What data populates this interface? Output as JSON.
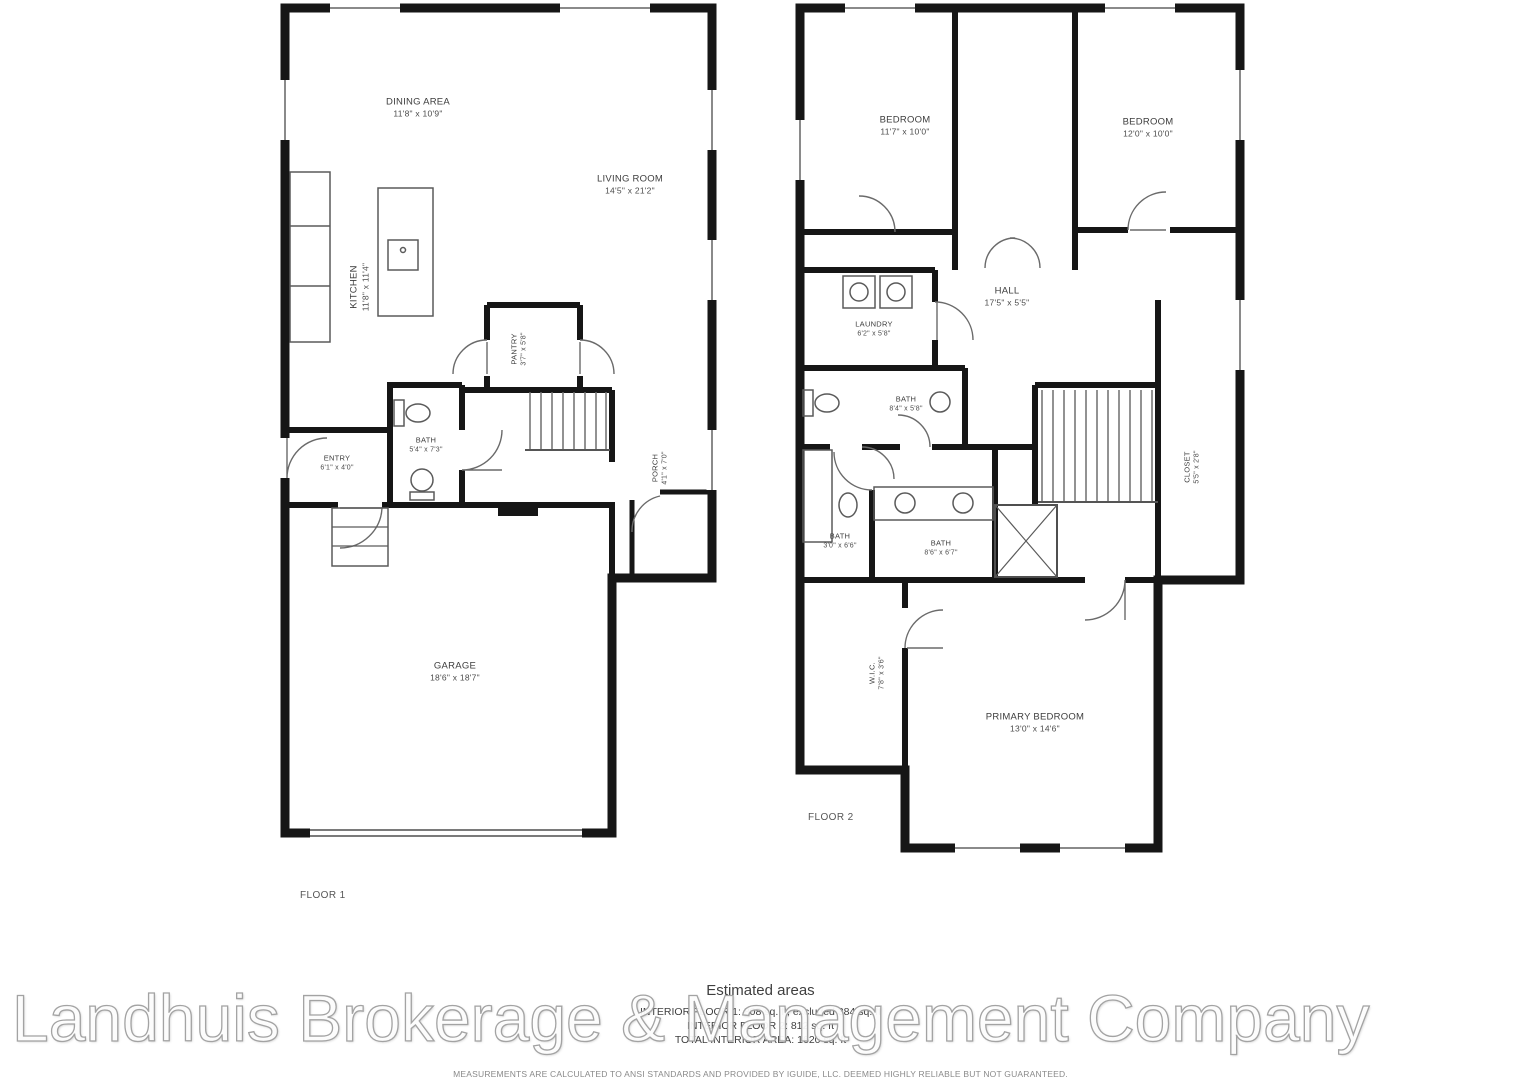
{
  "watermark": {
    "text": "Landhuis Brokerage & Management Company"
  },
  "floor1": {
    "name": "FLOOR 1",
    "rooms": {
      "dining": {
        "name": "DINING AREA",
        "dims": "11'8\" x 10'9\""
      },
      "living": {
        "name": "LIVING ROOM",
        "dims": "14'5\" x 21'2\""
      },
      "kitchen": {
        "name": "KITCHEN",
        "dims": "11'8\" x 11'4\""
      },
      "pantry": {
        "name": "PANTRY",
        "dims": "3'7\" x 5'8\""
      },
      "bath": {
        "name": "BATH",
        "dims": "5'4\" x 7'3\""
      },
      "entry": {
        "name": "ENTRY",
        "dims": "6'1\" x 4'0\""
      },
      "porch": {
        "name": "PORCH",
        "dims": "4'1\" x 7'0\""
      },
      "garage": {
        "name": "GARAGE",
        "dims": "18'6\" x 18'7\""
      }
    }
  },
  "floor2": {
    "name": "FLOOR 2",
    "rooms": {
      "bedroom_left": {
        "name": "BEDROOM",
        "dims": "11'7\" x 10'0\""
      },
      "bedroom_right": {
        "name": "BEDROOM",
        "dims": "12'0\" x 10'0\""
      },
      "laundry": {
        "name": "LAUNDRY",
        "dims": "6'2\" x 5'8\""
      },
      "hall": {
        "name": "HALL",
        "dims": "17'5\" x 5'5\""
      },
      "bath_hall": {
        "name": "BATH",
        "dims": "8'4\" x 5'8\""
      },
      "bath_small": {
        "name": "BATH",
        "dims": "3'0\" x 6'6\""
      },
      "bath_primary": {
        "name": "BATH",
        "dims": "8'6\" x 6'7\""
      },
      "wic": {
        "name": "W.I.C.",
        "dims": "7'8\" x 3'6\""
      },
      "closet_right": {
        "name": "CLOSET",
        "dims": "5'5\" x 2'8\""
      },
      "primary": {
        "name": "PRIMARY BEDROOM",
        "dims": "13'0\" x 14'6\""
      }
    }
  },
  "footer": {
    "estimated_title": "Estimated areas",
    "lines": [
      "INTERIOR FLOOR 1: 808 sq. ft, excluded 384 sq. ft",
      "INTERIOR FLOOR 2: 812 sq. ft",
      "TOTAL INTERIOR AREA: 1620 sq. ft"
    ],
    "disclaimer": "MEASUREMENTS ARE CALCULATED TO ANSI STANDARDS AND PROVIDED BY IGUIDE, LLC. DEEMED HIGHLY RELIABLE BUT NOT GUARANTEED."
  }
}
